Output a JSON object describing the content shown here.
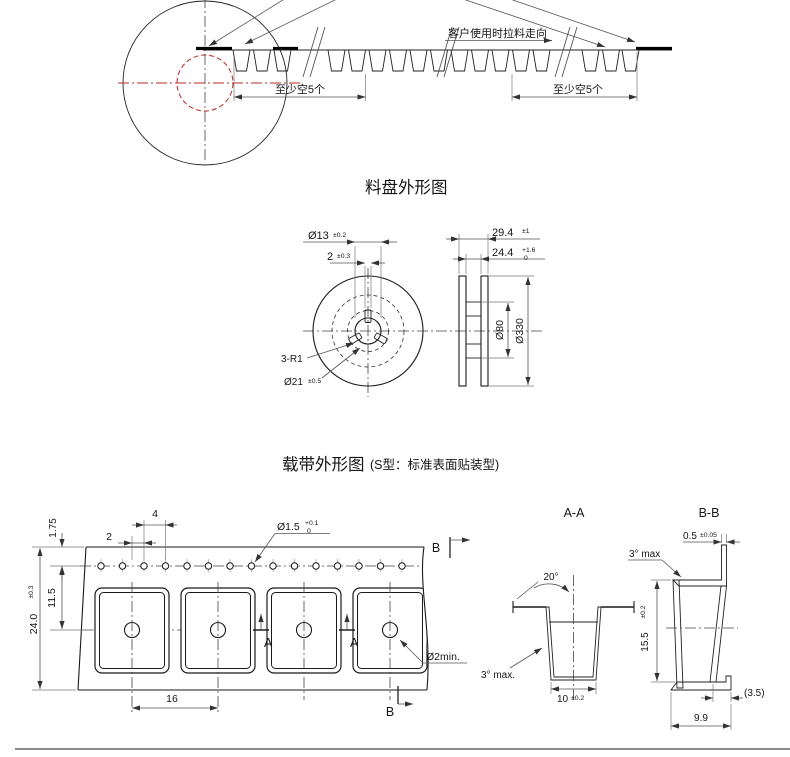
{
  "top_figure": {
    "pull_direction": "客户使用时拉料走向",
    "min_empty_left": "至少空5个",
    "min_empty_right": "至少空5个"
  },
  "reel": {
    "title": "料盘外形图",
    "dims": {
      "hole_dia": "Ø13",
      "hole_dia_tol": "±0.2",
      "slot_width": "2",
      "slot_width_tol": "±0.3",
      "outer_width": "29.4",
      "outer_width_tol": "±1",
      "inner_width": "24.4",
      "inner_width_tol_up": "+1.6",
      "inner_width_tol_dn": "0",
      "slot_radius": "3-R1",
      "hub_dia": "Ø21",
      "hub_dia_tol": "±0.5",
      "core_dia": "Ø80",
      "flange_dia": "Ø330"
    }
  },
  "tape": {
    "title": "载带外形图",
    "subtitle": "(S型：标准表面贴装型)",
    "dims": {
      "hole_pitch": "4",
      "hole_to_pocket": "2",
      "edge_to_hole": "1.75",
      "hole_to_center": "11.5",
      "tape_width": "24.0",
      "tape_width_tol": "±0.3",
      "sprocket_hole_dia": "Ø1.5",
      "sprocket_hole_tol_up": "+0.1",
      "sprocket_hole_tol_dn": "0",
      "pocket_pitch": "16",
      "center_hole": "Ø2min."
    },
    "section_a_label": "A",
    "section_b_label": "B"
  },
  "section_aa": {
    "title": "A-A",
    "draft_angle": "20°",
    "wall_angle": "3° max.",
    "pocket_width": "10",
    "pocket_width_tol": "±0.2"
  },
  "section_bb": {
    "title": "B-B",
    "lip_thickness": "0.5",
    "lip_thickness_tol": "±0.05",
    "flange_angle": "3° max",
    "pocket_depth": "15.5",
    "pocket_depth_tol": "±0.2",
    "bottom_offset": "(3.5)",
    "bottom_width": "9.9"
  }
}
